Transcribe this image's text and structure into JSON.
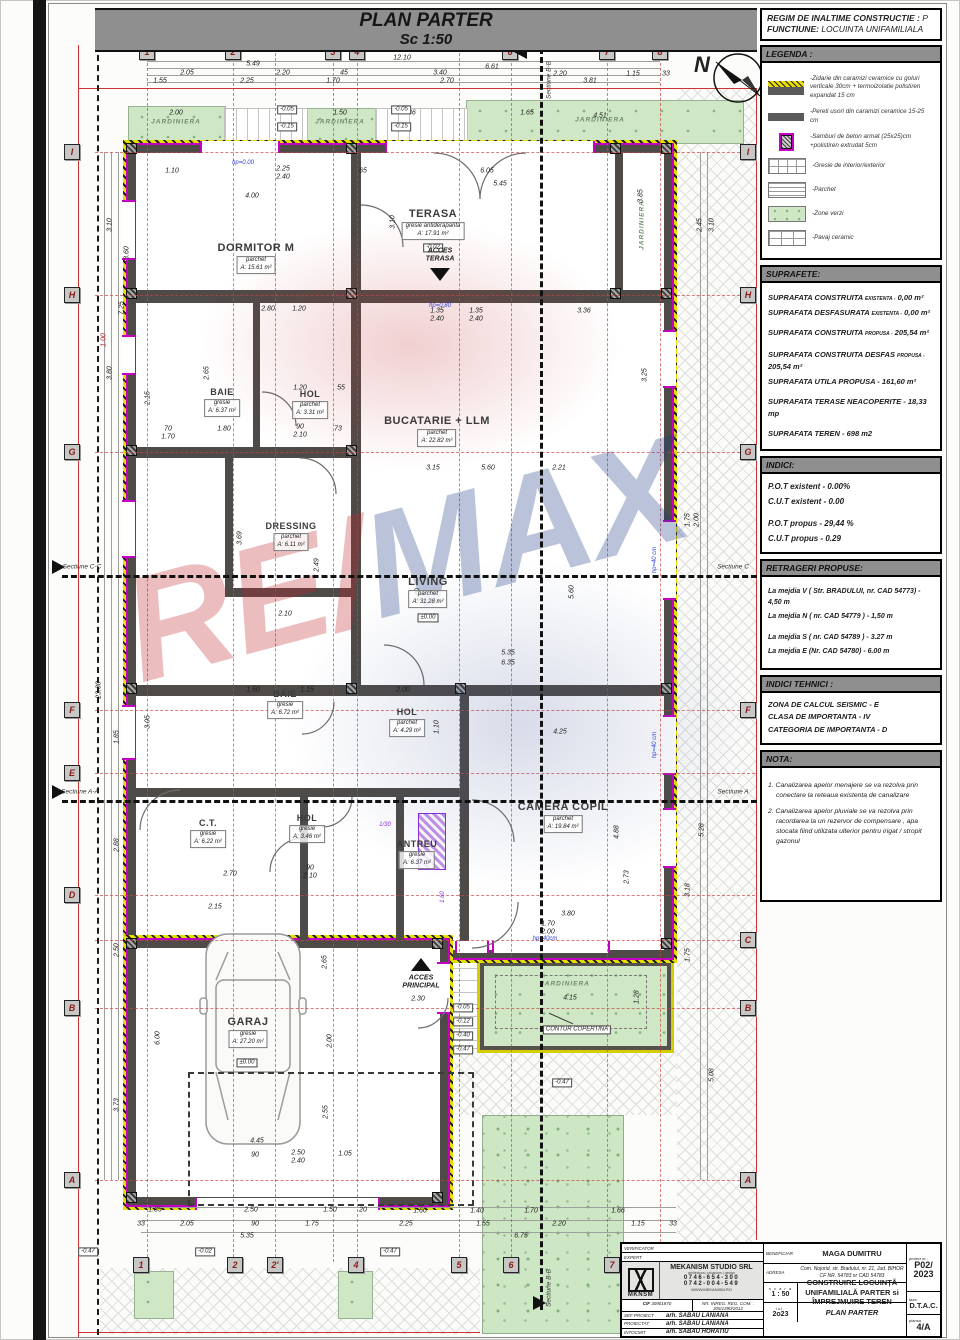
{
  "plan": {
    "title": "PLAN PARTER",
    "scale": "Sc 1:50",
    "north": "N"
  },
  "regim": {
    "l1": "REGIM DE INALTIME CONSTRUCTIE :",
    "v1": "P",
    "l2": "FUNCTIUNE:",
    "v2": "LOCUINTA UNIFAMILIALA"
  },
  "legend": {
    "title": "LEGENDA :",
    "items": [
      "-Zidarie din caramizi ceramice cu goluri verticale 30cm + termoizolatie polistiren expandat 15 cm",
      "-Pereti usori din caramizi ceramice 15-25 cm",
      "-Samburi de beton armat (25x25)cm +polistiren extrudat 5cm",
      "-Gresie de interior/exterior",
      "-Parchet",
      "-Zone verzi",
      "-Pavaj ceramic"
    ]
  },
  "suprafete": {
    "title": "SUPRAFETE:",
    "rows": [
      {
        "label": "SUPRAFATA CONSTRUITA",
        "sub": "EXISTENTA -",
        "value": "0,00 m²"
      },
      {
        "label": "SUPRAFATA DESFASURATA",
        "sub": "EXISTENTA -",
        "value": "0,00 m²"
      },
      {
        "label": "SUPRAFATA CONSTRUITA",
        "sub": "PROPUSA -",
        "value": "205,54 m²"
      },
      {
        "label": "SUPRAFATA CONSTRUITA DESFAS",
        "sub": "PROPUSA -",
        "value": "205,54 m²"
      },
      {
        "label": "SUPRAFATA UTILA PROPUSA -",
        "sub": "",
        "value": "161,60 m²"
      },
      {
        "label": "SUPRAFATA TERASE NEACOPERITE -",
        "sub": "",
        "value": "18,33 mp"
      },
      {
        "label": "SUPRAFATA TEREN -",
        "sub": "",
        "value": "698 m2"
      }
    ]
  },
  "indici": {
    "title": "INDICI:",
    "rows": [
      "P.O.T existent -  0.00%",
      "C.U.T existent -  0.00",
      "P.O.T propus -   29,44 %",
      "C.U.T propus - 0.29"
    ]
  },
  "retrageri": {
    "title": "RETRAGERI  PROPUSE:",
    "rows": [
      "La mejdia V ( Str. BRADULUI, nr. CAD 54773) - 4,50 m",
      "La mejdia N ( nr. CAD 54779 ) - 1,50 m",
      "La mejdia S ( nr. CAD 54789 ) - 3.27 m",
      "La mejdia E (Nr. CAD 54780) - 6.00 m"
    ]
  },
  "indici_tehnici": {
    "title": "INDICI TEHNICI :",
    "rows": [
      "ZONA DE CALCUL SEISMIC - E",
      "CLASA DE IMPORTANTA - IV",
      "CATEGORIA DE IMPORTANTA - D"
    ]
  },
  "nota": {
    "title": "NOTA:",
    "rows": [
      "1. Canalizarea apelor menajere se va rezolva prin conectare la reteaua existenta de canalizare",
      "2. Canalizarea apelor pluviale se va rezolva prin racordarea la un rezervor de compensare , apa stocata fiind utilizata ulterior pentru irigat / stropit gazonul"
    ]
  },
  "rooms": [
    {
      "name": "DORMITOR M",
      "floor": "parchet",
      "area": "A: 15.61 m²"
    },
    {
      "name": "TERASA",
      "floor": "gresie antiderapanta",
      "area": "A: 17.91 m²"
    },
    {
      "name": "BAIE",
      "floor": "gresie",
      "area": "A: 6.37 m²"
    },
    {
      "name": "HOL",
      "floor": "parchet",
      "area": "A: 3.31 m²"
    },
    {
      "name": "BUCATARIE + LLM",
      "floor": "parchet",
      "area": "A: 22.82 m²"
    },
    {
      "name": "DRESSING",
      "floor": "parchet",
      "area": "A: 6.11 m²"
    },
    {
      "name": "LIVING",
      "floor": "parchet",
      "area": "A: 31.28 m²"
    },
    {
      "name": "BAIE",
      "floor": "gresie",
      "area": "A: 6.72 m²"
    },
    {
      "name": "HOL",
      "floor": "parchet",
      "area": "A: 4.29 m²"
    },
    {
      "name": "C.T.",
      "floor": "gresie",
      "area": "A: 6.22 m²"
    },
    {
      "name": "HOL",
      "floor": "gresie",
      "area": "A: 3.46 m²"
    },
    {
      "name": "ANTREU",
      "floor": "gresie",
      "area": "A: 6.37 m²"
    },
    {
      "name": "CAMERA COPIL",
      "floor": "parchet",
      "area": "A: 19.84 m²"
    },
    {
      "name": "GARAJ",
      "floor": "gresie",
      "area": "A: 27.20 m²"
    }
  ],
  "labels": {
    "jardiniera": "JARDINIERA",
    "acces_terasa_1": "ACCES",
    "acces_terasa_2": "TERASA",
    "acces_principal_1": "ACCES",
    "acces_principal_2": "PRINCIPAL",
    "contur_copertina": "CONTUR COPERTINA",
    "sect_bb": "Sectiune B-B",
    "sect_cc": "Sectiune C-C",
    "sect_aa": "Sectiune A-A",
    "sect_c": "Sectiune C",
    "sect_a": "Sectiune A"
  },
  "watermark": {
    "re": "RE",
    "slash": "/",
    "max": "MAX"
  },
  "grid_bubbles": [
    {
      "t": "1",
      "x": 147,
      "y": 52
    },
    {
      "t": "2",
      "x": 233,
      "y": 52
    },
    {
      "t": "3",
      "x": 333,
      "y": 52
    },
    {
      "t": "4",
      "x": 357,
      "y": 52
    },
    {
      "t": "6",
      "x": 510,
      "y": 52
    },
    {
      "t": "7",
      "x": 607,
      "y": 52
    },
    {
      "t": "8",
      "x": 660,
      "y": 52
    },
    {
      "t": "1",
      "x": 141,
      "y": 1265
    },
    {
      "t": "2",
      "x": 235,
      "y": 1265
    },
    {
      "t": "2'",
      "x": 275,
      "y": 1265
    },
    {
      "t": "4",
      "x": 356,
      "y": 1265
    },
    {
      "t": "5",
      "x": 459,
      "y": 1265
    },
    {
      "t": "6",
      "x": 511,
      "y": 1265
    },
    {
      "t": "7",
      "x": 612,
      "y": 1265
    },
    {
      "t": "I",
      "x": 72,
      "y": 152
    },
    {
      "t": "H",
      "x": 72,
      "y": 295
    },
    {
      "t": "G",
      "x": 72,
      "y": 452
    },
    {
      "t": "F",
      "x": 72,
      "y": 710
    },
    {
      "t": "E",
      "x": 72,
      "y": 773
    },
    {
      "t": "D",
      "x": 72,
      "y": 895
    },
    {
      "t": "B",
      "x": 72,
      "y": 1008
    },
    {
      "t": "A",
      "x": 72,
      "y": 1180
    },
    {
      "t": "I",
      "x": 748,
      "y": 152
    },
    {
      "t": "H",
      "x": 748,
      "y": 295
    },
    {
      "t": "G",
      "x": 748,
      "y": 452
    },
    {
      "t": "F",
      "x": 748,
      "y": 710
    },
    {
      "t": "C",
      "x": 748,
      "y": 940
    },
    {
      "t": "B",
      "x": 748,
      "y": 1008
    },
    {
      "t": "A",
      "x": 748,
      "y": 1180
    }
  ],
  "dims": [
    {
      "t": "12.10",
      "x": 402,
      "y": 58
    },
    {
      "t": "5.49",
      "x": 253,
      "y": 64
    },
    {
      "t": "6.61",
      "x": 492,
      "y": 67
    },
    {
      "t": "2.05",
      "x": 187,
      "y": 73
    },
    {
      "t": "2.20",
      "x": 283,
      "y": 73
    },
    {
      "t": "45",
      "x": 344,
      "y": 73
    },
    {
      "t": "3.40",
      "x": 440,
      "y": 73
    },
    {
      "t": "2.20",
      "x": 560,
      "y": 74
    },
    {
      "t": "1.15",
      "x": 633,
      "y": 74
    },
    {
      "t": "33",
      "x": 666,
      "y": 74
    },
    {
      "t": "1.55",
      "x": 160,
      "y": 81
    },
    {
      "t": "2.25",
      "x": 247,
      "y": 81
    },
    {
      "t": "1.70",
      "x": 333,
      "y": 81
    },
    {
      "t": "2.70",
      "x": 447,
      "y": 81
    },
    {
      "t": "3.81",
      "x": 590,
      "y": 81
    },
    {
      "t": "2.00",
      "x": 176,
      "y": 113
    },
    {
      "t": "1.50",
      "x": 340,
      "y": 113
    },
    {
      "t": "1.86",
      "x": 409,
      "y": 113
    },
    {
      "t": "1.65",
      "x": 527,
      "y": 113
    },
    {
      "t": "4.51",
      "x": 600,
      "y": 116
    },
    {
      "t": "1.10",
      "x": 172,
      "y": 171
    },
    {
      "t": "2.25",
      "x": 283,
      "y": 169
    },
    {
      "t": "2.40",
      "x": 283,
      "y": 177
    },
    {
      "t": "65",
      "x": 363,
      "y": 171
    },
    {
      "t": "6.05",
      "x": 487,
      "y": 171
    },
    {
      "t": "5.45",
      "x": 500,
      "y": 184
    },
    {
      "t": "4.00",
      "x": 252,
      "y": 196
    },
    {
      "t": "3.10",
      "x": 393,
      "y": 222,
      "v": 1
    },
    {
      "t": "3.60",
      "x": 127,
      "y": 253,
      "v": 1
    },
    {
      "t": "3.85",
      "x": 641,
      "y": 196,
      "v": 1
    },
    {
      "t": "2.80",
      "x": 268,
      "y": 309
    },
    {
      "t": "1.20",
      "x": 299,
      "y": 309
    },
    {
      "t": "1.35",
      "x": 437,
      "y": 311
    },
    {
      "t": "2.40",
      "x": 437,
      "y": 319
    },
    {
      "t": "1.35",
      "x": 476,
      "y": 311
    },
    {
      "t": "2.40",
      "x": 476,
      "y": 319
    },
    {
      "t": "3.36",
      "x": 584,
      "y": 311
    },
    {
      "t": "2.15",
      "x": 148,
      "y": 398,
      "v": 1
    },
    {
      "t": "2.65",
      "x": 207,
      "y": 373,
      "v": 1
    },
    {
      "t": "1.20",
      "x": 300,
      "y": 388
    },
    {
      "t": "55",
      "x": 341,
      "y": 388
    },
    {
      "t": "70",
      "x": 168,
      "y": 429
    },
    {
      "t": "1.70",
      "x": 168,
      "y": 437
    },
    {
      "t": "1.80",
      "x": 224,
      "y": 429
    },
    {
      "t": "90",
      "x": 300,
      "y": 427
    },
    {
      "t": "2.10",
      "x": 300,
      "y": 435
    },
    {
      "t": "73",
      "x": 338,
      "y": 429
    },
    {
      "t": "3.25",
      "x": 645,
      "y": 375,
      "v": 1
    },
    {
      "t": "3.15",
      "x": 433,
      "y": 468
    },
    {
      "t": "5.60",
      "x": 488,
      "y": 468
    },
    {
      "t": "2.21",
      "x": 559,
      "y": 468
    },
    {
      "t": "3.69",
      "x": 240,
      "y": 538,
      "v": 1
    },
    {
      "t": "2.10",
      "x": 285,
      "y": 614
    },
    {
      "t": "2.49",
      "x": 317,
      "y": 565,
      "v": 1
    },
    {
      "t": "3.40",
      "x": 418,
      "y": 595,
      "v": 1
    },
    {
      "t": "5.35",
      "x": 508,
      "y": 653
    },
    {
      "t": "6.35",
      "x": 508,
      "y": 663
    },
    {
      "t": "5.60",
      "x": 572,
      "y": 592,
      "v": 1
    },
    {
      "t": "1.50",
      "x": 253,
      "y": 690
    },
    {
      "t": "1.15",
      "x": 307,
      "y": 690
    },
    {
      "t": "2.00",
      "x": 403,
      "y": 690
    },
    {
      "t": "3.05",
      "x": 148,
      "y": 722,
      "v": 1
    },
    {
      "t": "4.25",
      "x": 560,
      "y": 732
    },
    {
      "t": "1.10",
      "x": 437,
      "y": 727,
      "v": 1
    },
    {
      "t": "2.70",
      "x": 230,
      "y": 874
    },
    {
      "t": "90",
      "x": 310,
      "y": 868
    },
    {
      "t": "2.10",
      "x": 310,
      "y": 876
    },
    {
      "t": "2.15",
      "x": 215,
      "y": 907
    },
    {
      "t": "3.80",
      "x": 568,
      "y": 914
    },
    {
      "t": "1.70",
      "x": 548,
      "y": 924
    },
    {
      "t": "2.00",
      "x": 548,
      "y": 932
    },
    {
      "t": "2.73",
      "x": 627,
      "y": 877,
      "v": 1
    },
    {
      "t": "4.88",
      "x": 617,
      "y": 832,
      "v": 1
    },
    {
      "t": "3.18",
      "x": 688,
      "y": 890,
      "v": 1
    },
    {
      "t": "5.28",
      "x": 702,
      "y": 830,
      "v": 1
    },
    {
      "t": "2.65",
      "x": 325,
      "y": 962,
      "v": 1
    },
    {
      "t": "2.30",
      "x": 418,
      "y": 999
    },
    {
      "t": "2.00",
      "x": 330,
      "y": 1041,
      "v": 1
    },
    {
      "t": "6.00",
      "x": 158,
      "y": 1038,
      "v": 1
    },
    {
      "t": "2.55",
      "x": 326,
      "y": 1112,
      "v": 1
    },
    {
      "t": "4.45",
      "x": 257,
      "y": 1141
    },
    {
      "t": "4.15",
      "x": 570,
      "y": 998
    },
    {
      "t": "1.28",
      "x": 637,
      "y": 997,
      "v": 1
    },
    {
      "t": "5.08",
      "x": 712,
      "y": 1075,
      "v": 1
    },
    {
      "t": "90",
      "x": 255,
      "y": 1155
    },
    {
      "t": "2.50",
      "x": 298,
      "y": 1153
    },
    {
      "t": "2.40",
      "x": 298,
      "y": 1161
    },
    {
      "t": "1.05",
      "x": 345,
      "y": 1154
    },
    {
      "t": "1.35",
      "x": 155,
      "y": 1210
    },
    {
      "t": "2.50",
      "x": 251,
      "y": 1210
    },
    {
      "t": "1.50",
      "x": 330,
      "y": 1210
    },
    {
      "t": "20",
      "x": 363,
      "y": 1210
    },
    {
      "t": "1.60",
      "x": 420,
      "y": 1211
    },
    {
      "t": "1.40",
      "x": 477,
      "y": 1211
    },
    {
      "t": "1.70",
      "x": 531,
      "y": 1211
    },
    {
      "t": "1.66",
      "x": 618,
      "y": 1211
    },
    {
      "t": "33",
      "x": 141,
      "y": 1224
    },
    {
      "t": "2.05",
      "x": 187,
      "y": 1224
    },
    {
      "t": "90",
      "x": 255,
      "y": 1224
    },
    {
      "t": "1.75",
      "x": 312,
      "y": 1224
    },
    {
      "t": "2.25",
      "x": 406,
      "y": 1224
    },
    {
      "t": "1.55",
      "x": 483,
      "y": 1224
    },
    {
      "t": "2.20",
      "x": 559,
      "y": 1224
    },
    {
      "t": "1.15",
      "x": 638,
      "y": 1224
    },
    {
      "t": "33",
      "x": 673,
      "y": 1224
    },
    {
      "t": "5.35",
      "x": 247,
      "y": 1236
    },
    {
      "t": "6.75",
      "x": 521,
      "y": 1236
    },
    {
      "t": "3.10",
      "x": 110,
      "y": 225,
      "v": 1
    },
    {
      "t": "7.25",
      "x": 122,
      "y": 308,
      "v": 1
    },
    {
      "t": "1.00",
      "x": 104,
      "y": 340,
      "v": 1,
      "c": "red"
    },
    {
      "t": "3.80",
      "x": 110,
      "y": 373,
      "v": 1
    },
    {
      "t": "23.30",
      "x": 99,
      "y": 690,
      "v": 1
    },
    {
      "t": "1.85",
      "x": 117,
      "y": 737,
      "v": 1
    },
    {
      "t": "2.88",
      "x": 117,
      "y": 845,
      "v": 1
    },
    {
      "t": "2.50",
      "x": 117,
      "y": 950,
      "v": 1
    },
    {
      "t": "3.73",
      "x": 117,
      "y": 1105,
      "v": 1
    },
    {
      "t": "3.10",
      "x": 712,
      "y": 225,
      "v": 1
    },
    {
      "t": "2.45",
      "x": 700,
      "y": 225,
      "v": 1
    },
    {
      "t": "1.75",
      "x": 688,
      "y": 520,
      "v": 1
    },
    {
      "t": "2.00",
      "x": 697,
      "y": 520,
      "v": 1
    },
    {
      "t": "1.75",
      "x": 688,
      "y": 955,
      "v": 1
    },
    {
      "t": "hp=0.00",
      "x": 243,
      "y": 163,
      "c": "blue"
    },
    {
      "t": "hp=0.80",
      "x": 440,
      "y": 306,
      "c": "blue"
    },
    {
      "t": "hp=40 cm",
      "x": 655,
      "y": 560,
      "v": 1,
      "c": "blue"
    },
    {
      "t": "hp=40 cm",
      "x": 655,
      "y": 745,
      "v": 1,
      "c": "blue"
    },
    {
      "t": "hp=40cm",
      "x": 545,
      "y": 939,
      "c": "blue"
    },
    {
      "t": "1/30",
      "x": 385,
      "y": 825,
      "c": "violet"
    },
    {
      "t": "1.60",
      "x": 443,
      "y": 897,
      "v": 1,
      "c": "violet"
    }
  ],
  "levels": [
    {
      "t": "±0.00",
      "x": 428,
      "y": 618
    },
    {
      "t": "±0.00",
      "x": 247,
      "y": 1063
    },
    {
      "t": "-0.02",
      "x": 433,
      "y": 248
    },
    {
      "t": "-0.05",
      "x": 287,
      "y": 110
    },
    {
      "t": "-0.15",
      "x": 287,
      "y": 127
    },
    {
      "t": "-0.05",
      "x": 401,
      "y": 110
    },
    {
      "t": "-0.15",
      "x": 401,
      "y": 127
    },
    {
      "t": "-0.05",
      "x": 463,
      "y": 1008
    },
    {
      "t": "-0.12",
      "x": 463,
      "y": 1022
    },
    {
      "t": "-0.40",
      "x": 463,
      "y": 1036
    },
    {
      "t": "-0.47",
      "x": 463,
      "y": 1050
    },
    {
      "t": "-0.47",
      "x": 562,
      "y": 1083
    },
    {
      "t": "-0.47",
      "x": 88,
      "y": 1252
    },
    {
      "t": "-0.02",
      "x": 205,
      "y": 1252
    },
    {
      "t": "-0.47",
      "x": 390,
      "y": 1252
    }
  ],
  "titleblock": {
    "verificator": "VERIFICATOR",
    "expert": "EXPERT",
    "firm": "MEKANISM STUDIO SRL",
    "firm_sub": "arhitectura | urbanism | design",
    "phone1": "0746-654-300",
    "phone2": "0742-004-549",
    "web": "WWW.MEKANISM.RO",
    "logo": "MKNSM",
    "cif_label": "CIF",
    "cif": "30901870",
    "reg_label": "NR. INREG. REG. COM. :",
    "reg": "J05/1390/2012",
    "sef_label": "SEF PROIECT",
    "sef": "arh. SABAU LANIANA",
    "proiectat_label": "PROIECTAT",
    "proiectat": "arh. SABAU LANIANA",
    "intocmit_label": "INTOCMIT",
    "intocmit": "arh. SABAU HORATIU",
    "beneficiar_label": "BENEFICIAR",
    "beneficiar": "MAGA DUMITRU",
    "adresa_label": "ADRESA",
    "adresa1": "Com. Nojorid, str. Bradului, nr. 21, Jud. BIHOR",
    "adresa2": "CF NR. 54783  nr CAD  54783",
    "scara_label": "s c a r a",
    "scara": "1 : 50",
    "data_label": "iul.",
    "data": "2o23",
    "proiect": "CONSTRUIRE LOCUINȚĂ UNIFAMILIALĂ PARTER si ÎMPREJMUIRE TEREN",
    "plansa_title": "PLAN PARTER",
    "pr_nr_label": "proiect nr.:",
    "pr_nr": "P02/",
    "pr_an": "2023",
    "faza_label": "faza",
    "faza": "D.T.A.C.",
    "plansa_label": "plansa",
    "plansa": "4/A"
  }
}
